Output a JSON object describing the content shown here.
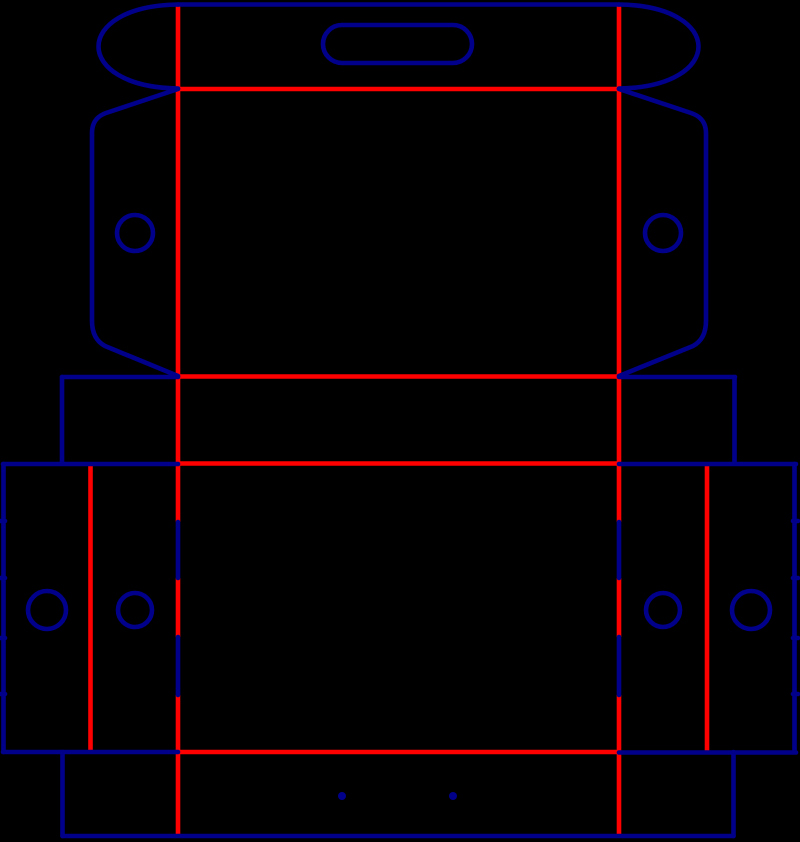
{
  "canvas": {
    "width": 800,
    "height": 842,
    "background": "#000000"
  },
  "styles": {
    "cut_color": "#00008B",
    "crease_color": "#FF0000",
    "cut_width": 4.6,
    "crease_width": 4.6
  },
  "dieline": {
    "cut_lines": [
      {
        "name": "top-edge-cut",
        "d": "M 178 4.5 L 619 4.5"
      },
      {
        "name": "top-left-ear-cut",
        "d": "M 178 4.5 C 72 6, 72 87, 178 88.5"
      },
      {
        "name": "top-right-ear-cut",
        "d": "M 619 4.5 C 725 6, 725 87, 619 88.5"
      },
      {
        "name": "left-side-ear-cut",
        "d": "M 178 89 L 106 113 Q 92 118 92 133 L 92 321 Q 92 339 105 346 L 178 376"
      },
      {
        "name": "right-side-ear-cut",
        "d": "M 619 89 L 691 113 Q 706 118 706 133 L 706 321 Q 706 339 693 346 L 619 376"
      },
      {
        "name": "neck-top-left-cut",
        "d": "M 62 377 L 178 377"
      },
      {
        "name": "neck-top-right-cut",
        "d": "M 619 377 L 735 377"
      },
      {
        "name": "neck-left-edge-cut",
        "d": "M 62 377 L 62 463"
      },
      {
        "name": "neck-right-edge-cut",
        "d": "M 734.5 377 L 734.5 463"
      },
      {
        "name": "shoulder-left-cut",
        "d": "M 3 464 L 178 464"
      },
      {
        "name": "shoulder-right-cut",
        "d": "M 619 464 L 796 464"
      },
      {
        "name": "glue-flap-left-edge-cut",
        "d": "M 3.5 464 L 3.5 752 M 0 521 L 5 521 M 0 578 L 5 578 M 0 638 L 5 638 M 0 694 L 5 694"
      },
      {
        "name": "glue-flap-right-edge-cut",
        "d": "M 794.5 464 L 794.5 752 M 793 521 L 798 521 M 793 578 L 798 578 M 793 638 L 798 638 M 793 694 L 798 694"
      },
      {
        "name": "flap-bottom-left-cut",
        "d": "M 3 752 L 178 752"
      },
      {
        "name": "flap-bottom-right-cut",
        "d": "M 619 752.5 L 796 752.5"
      },
      {
        "name": "perforation-left-cut",
        "d": "M 178 522 L 178 578 M 178 637 L 178 695"
      },
      {
        "name": "perforation-right-cut",
        "d": "M 619 522 L 619 578 M 619 637 L 619 695"
      },
      {
        "name": "bottom-strip-left-edge-cut",
        "d": "M 62.5 752 L 62.5 836"
      },
      {
        "name": "bottom-strip-bottom-edge-cut",
        "d": "M 62.5 836 L 733.5 836"
      },
      {
        "name": "bottom-strip-right-edge-cut",
        "d": "M 733.5 752 L 733.5 836"
      }
    ],
    "crease_lines": [
      {
        "name": "crease-vertical-left",
        "d": "M 178 4 L 178 522 M 178 578 L 178 637 M 178 695 L 178 836"
      },
      {
        "name": "crease-vertical-right",
        "d": "M 619 4 L 619 522 M 619 578 L 619 637 M 619 695 L 619 836"
      },
      {
        "name": "crease-top-flap",
        "d": "M 178 89 L 619 89"
      },
      {
        "name": "crease-panel-bottom",
        "d": "M 178 376.5 L 619 376.5"
      },
      {
        "name": "crease-shoulder",
        "d": "M 178 463.5 L 619 463.5"
      },
      {
        "name": "crease-bottom-strip",
        "d": "M 178 752 L 619 752"
      },
      {
        "name": "crease-glue-flap-left",
        "d": "M 90.5 465 L 90.5 752"
      },
      {
        "name": "crease-glue-flap-right",
        "d": "M 707 465 L 707 752"
      }
    ],
    "holes": [
      {
        "name": "ear-hole-left",
        "cx": 135,
        "cy": 233,
        "r": 18
      },
      {
        "name": "ear-hole-right",
        "cx": 663,
        "cy": 233,
        "r": 18
      },
      {
        "name": "side-hole-outer-left",
        "cx": 47,
        "cy": 610,
        "r": 19
      },
      {
        "name": "side-hole-inner-left",
        "cx": 135,
        "cy": 610,
        "r": 17
      },
      {
        "name": "side-hole-inner-right",
        "cx": 663,
        "cy": 610,
        "r": 17
      },
      {
        "name": "side-hole-outer-right",
        "cx": 751,
        "cy": 610,
        "r": 19
      }
    ],
    "dots": [
      {
        "name": "bottom-dot-left",
        "cx": 342,
        "cy": 796,
        "r": 4
      },
      {
        "name": "bottom-dot-right",
        "cx": 453,
        "cy": 796,
        "r": 4
      }
    ],
    "handle_slot": {
      "name": "handle-slot-cut",
      "x": 323,
      "y": 25,
      "width": 149,
      "height": 38,
      "rx": 19
    }
  }
}
